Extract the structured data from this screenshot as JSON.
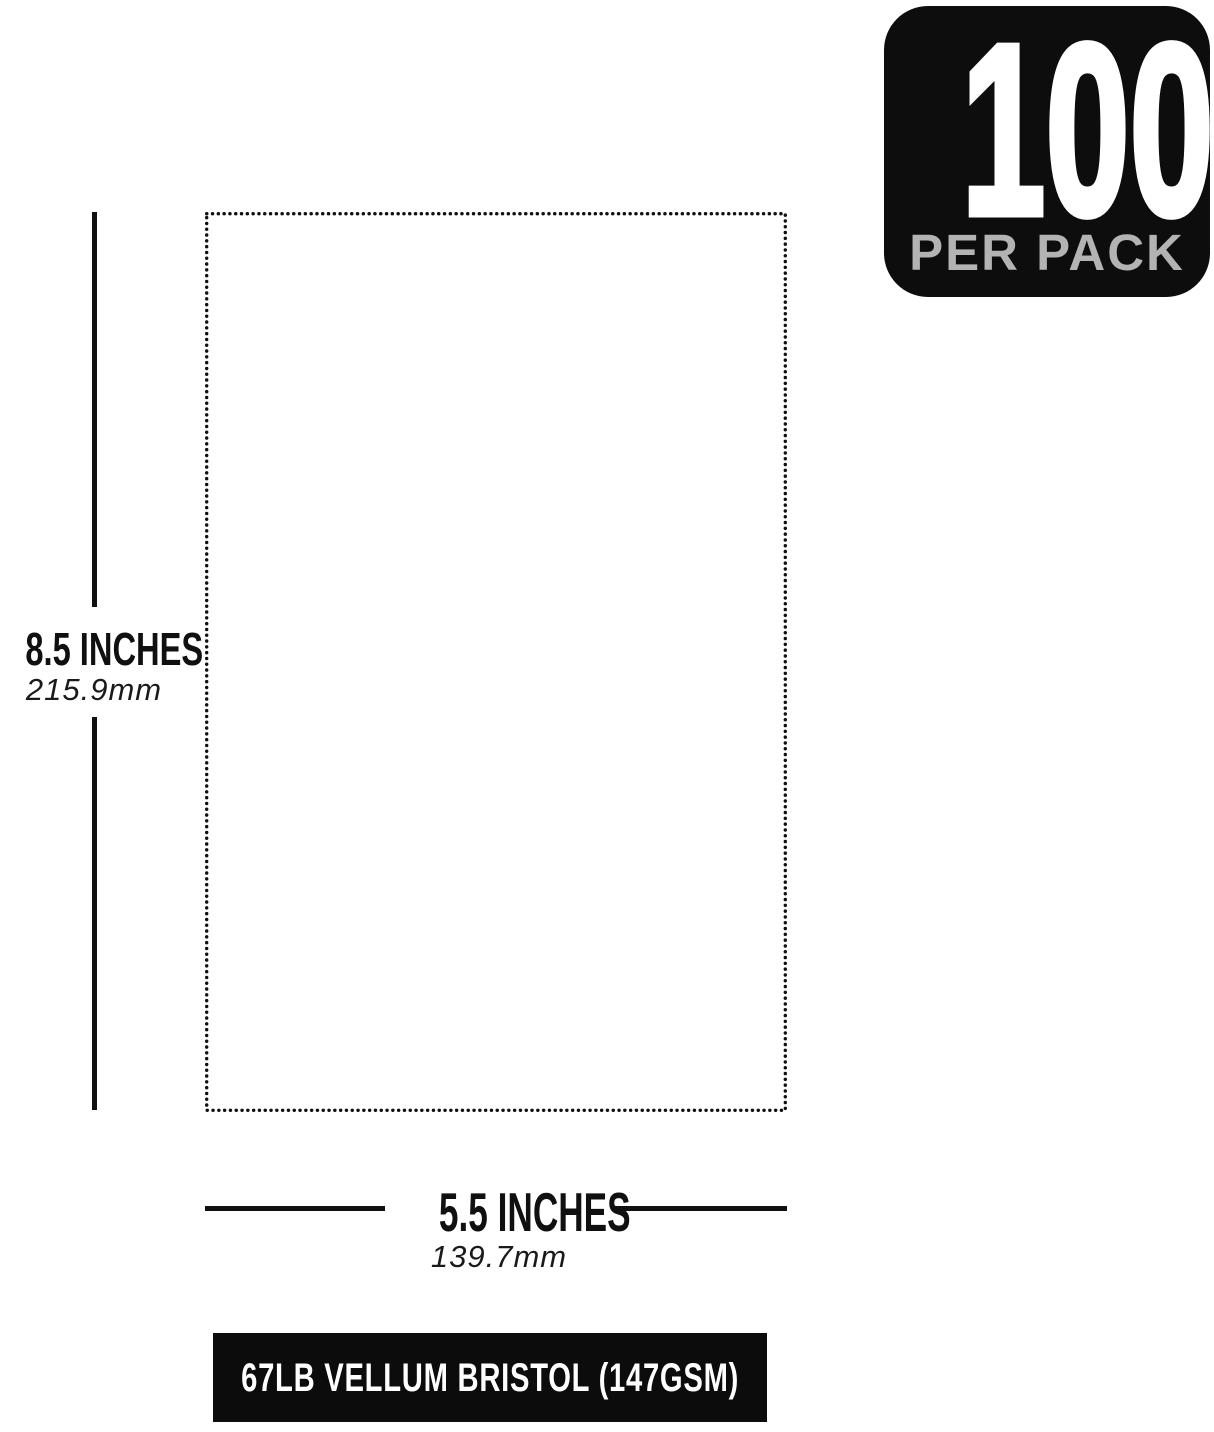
{
  "badge": {
    "count": "100",
    "label": "PER PACK",
    "bg_color": "#0d0d0d",
    "count_color": "#ffffff",
    "label_color": "#b3b3b3"
  },
  "dimensions": {
    "height": {
      "label": "8.5 INCHES",
      "metric": "215.9mm"
    },
    "width": {
      "label": "5.5 INCHES",
      "metric": "139.7mm"
    },
    "line_color": "#101010"
  },
  "footer": {
    "text": "67LB VELLUM BRISTOL (147GSM)",
    "bg_color": "#0c0c0c",
    "text_color": "#ffffff"
  }
}
